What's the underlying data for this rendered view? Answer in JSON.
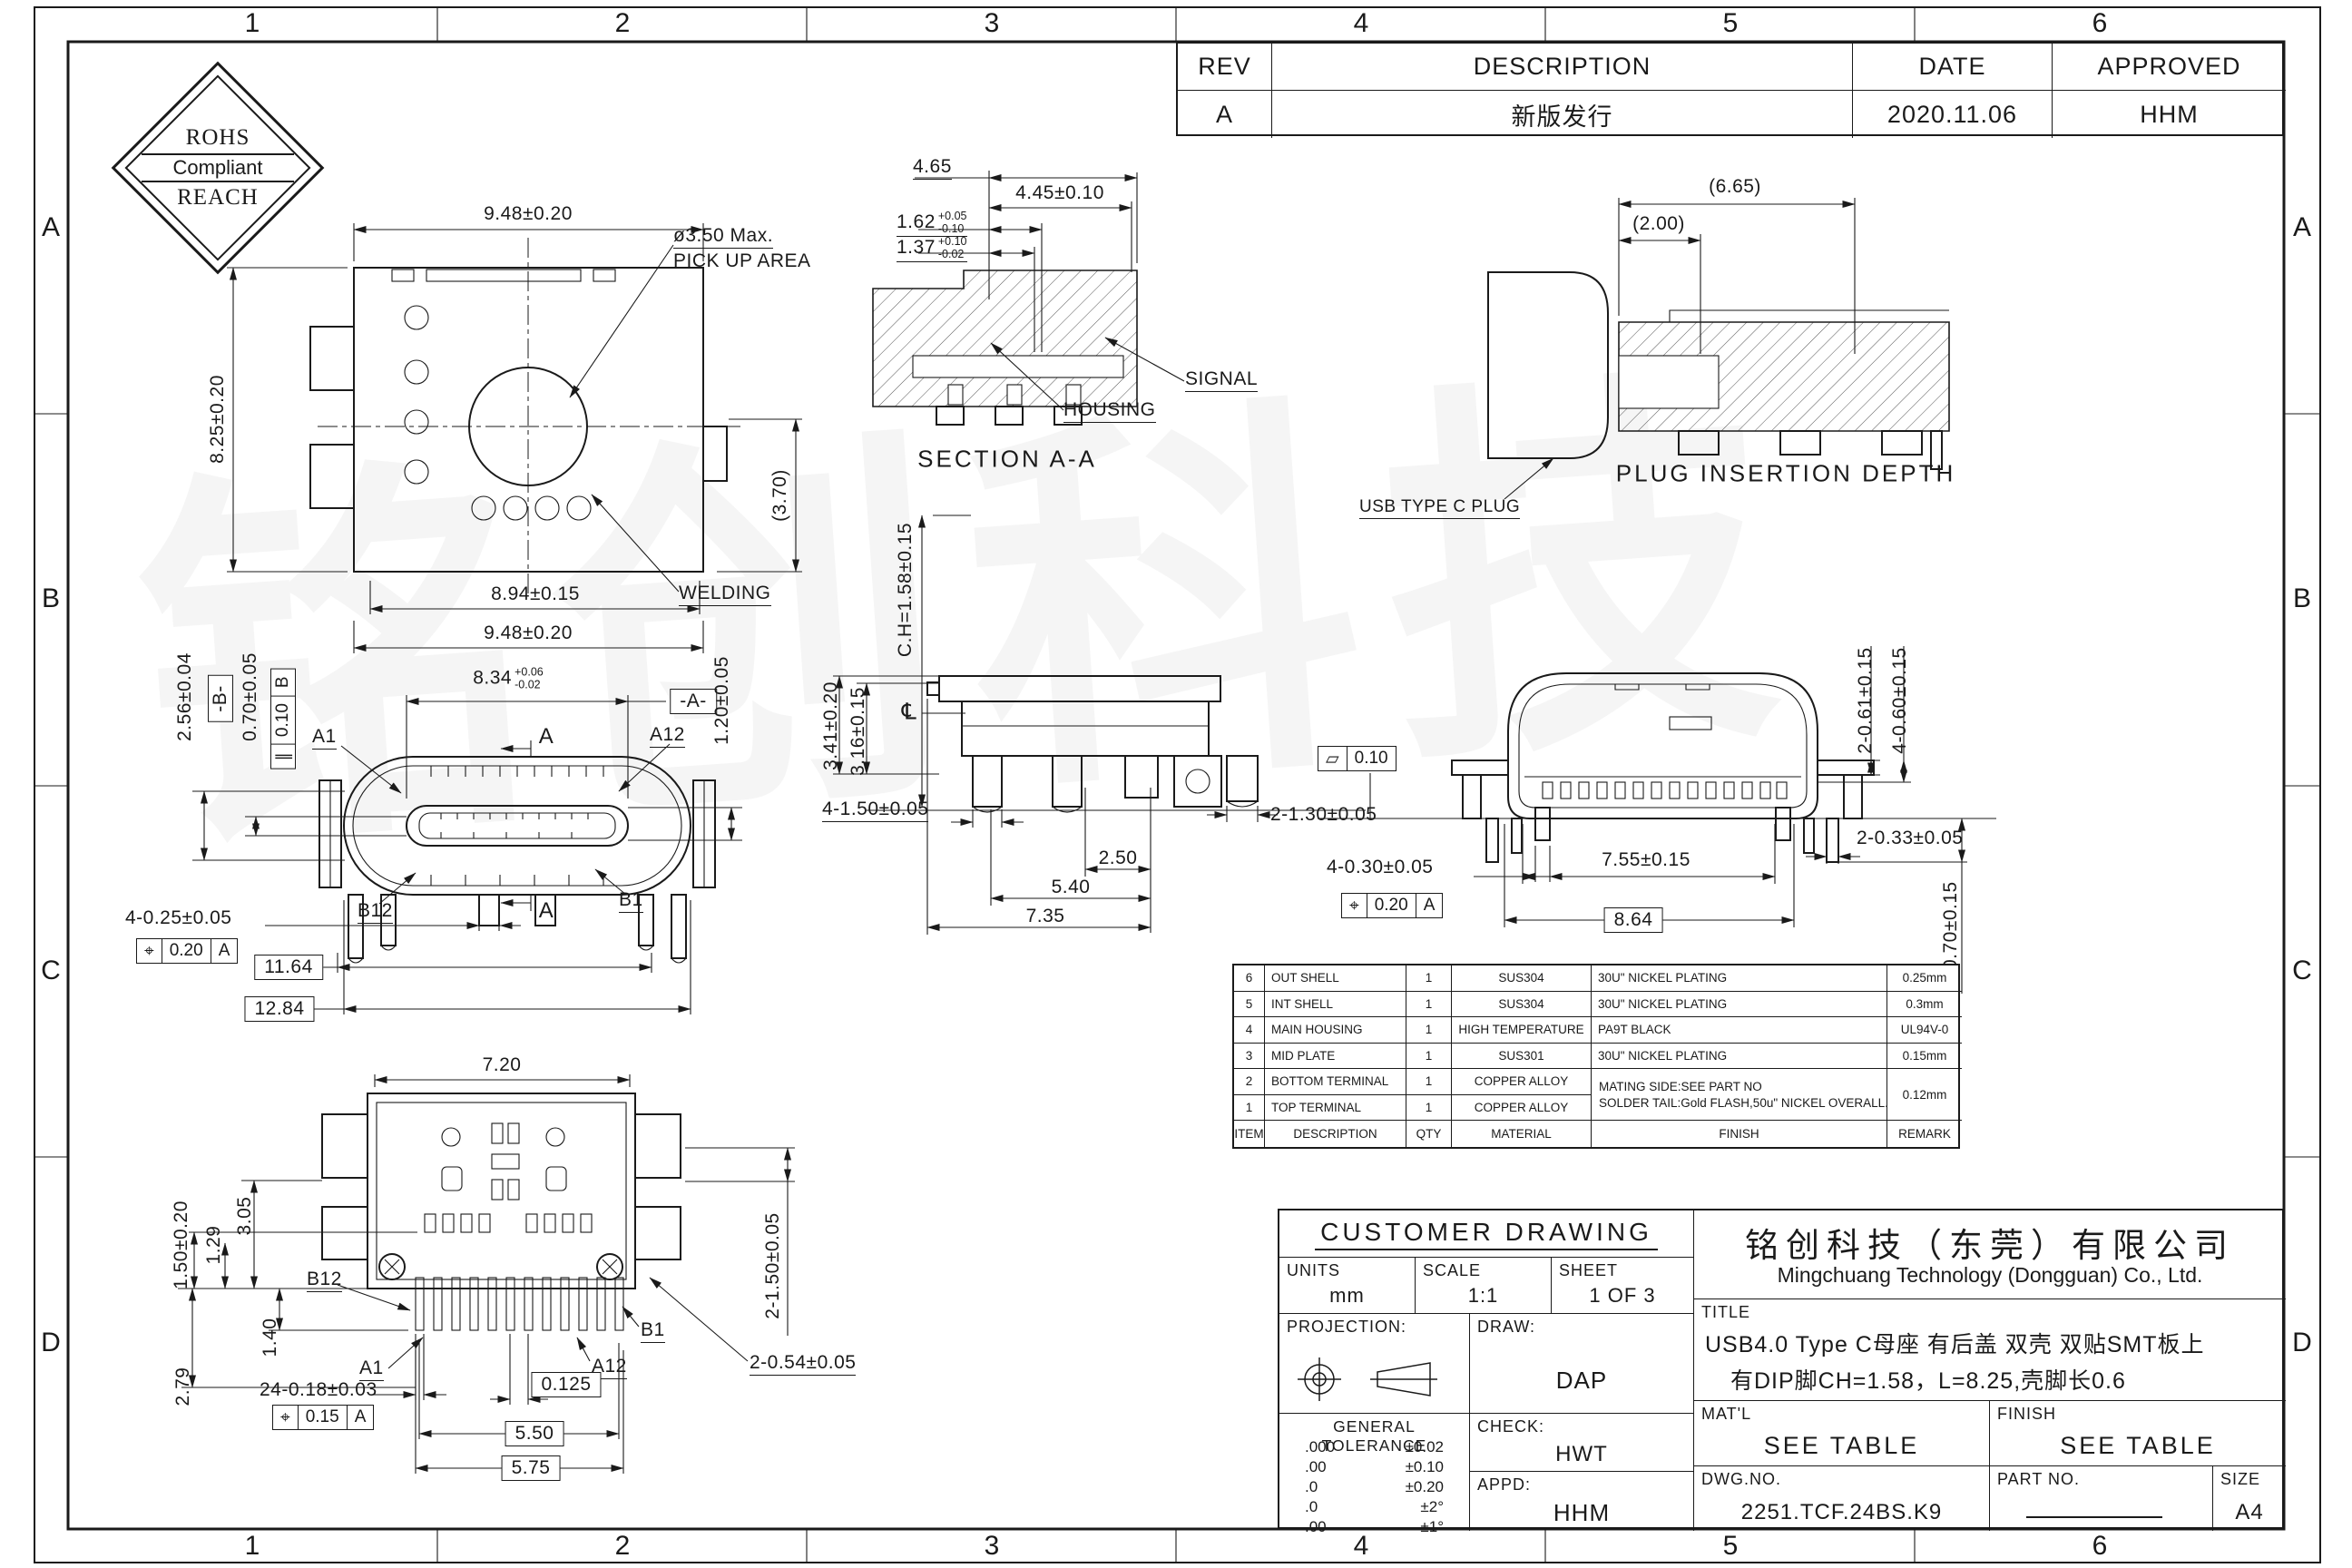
{
  "sheet": {
    "cols": [
      "1",
      "2",
      "3",
      "4",
      "5",
      "6"
    ],
    "rows": [
      "A",
      "B",
      "C",
      "D"
    ],
    "watermark": "铭创科技"
  },
  "badge": {
    "top": "ROHS",
    "mid": "Compliant",
    "bottom": "REACH"
  },
  "rev_table": {
    "headers": {
      "rev": "REV",
      "description": "DESCRIPTION",
      "date": "DATE",
      "approved": "APPROVED"
    },
    "row": {
      "rev": "A",
      "description": "新版发行",
      "date": "2020.11.06",
      "approved": "HHM"
    }
  },
  "top_view": {
    "dim_width_top": "9.48±0.20",
    "dim_height_left": "8.25±0.20",
    "dim_width_bot1": "8.94±0.15",
    "dim_width_bot2": "9.48±0.20",
    "dim_depth": "(3.70)",
    "pickup_line1": "ø3.50  Max.",
    "pickup_line2": "PICK UP AREA",
    "welding": "WELDING"
  },
  "section_view": {
    "title": "SECTION A-A",
    "dim_465": "4.65",
    "dim_445": "4.45±0.10",
    "dim_162": "1.62",
    "dim_162_up": "+0.05",
    "dim_162_dn": "-0.10",
    "dim_137": "1.37",
    "dim_137_up": "+0.10",
    "dim_137_dn": "-0.02",
    "label_signal": "SIGNAL",
    "label_housing": "HOUSING"
  },
  "plug_view": {
    "title": "PLUG INSERTION DEPTH",
    "dim_665": "(6.65)",
    "dim_200": "(2.00)",
    "label_plug": "USB TYPE C PLUG"
  },
  "front_view": {
    "dim_834": "8.34",
    "dim_834_up": "+0.06",
    "dim_834_dn": "-0.02",
    "datum_a": "-A-",
    "datum_b": "-B-",
    "dim_256": "2.56±0.04",
    "dim_070": "0.70±0.05",
    "fcf_par": {
      "sym": "∥",
      "val": "0.10",
      "ref": "B"
    },
    "dim_120": "1.20±0.05",
    "pin_a1": "A1",
    "pin_a12": "A12",
    "pin_b1": "B1",
    "pin_b12": "B12",
    "sec_mark": "A",
    "dim_feet": "4-0.25±0.05",
    "fcf_pos": {
      "sym": "⌖",
      "val": "0.20",
      "ref": "A"
    },
    "dim_1164": "11.64",
    "dim_1284": "12.84"
  },
  "side_view": {
    "dim_ch": "C.H=1.58±0.15",
    "centerline_sym": "℄",
    "dim_341": "3.41±0.20",
    "dim_316": "3.16±0.15",
    "dim_legs": "4-1.50±0.05",
    "dim_250": "2.50",
    "dim_540": "5.40",
    "dim_735": "7.35",
    "dim_130": "2-1.30±0.05"
  },
  "end_view": {
    "fcf_flat": {
      "sym": "▱",
      "val": "0.10"
    },
    "dim_061": "2-0.61±0.15",
    "dim_060": "4-0.60±0.15",
    "dim_033": "2-0.33±0.05",
    "dim_755": "7.55±0.15",
    "dim_864": "8.64",
    "dim_030": "4-0.30±0.05",
    "fcf_pos": {
      "sym": "⌖",
      "val": "0.20",
      "ref": "A"
    },
    "dim_070": "4-0.70±0.15"
  },
  "bottom_view": {
    "dim_720": "7.20",
    "dim_150": "1.50±0.20",
    "dim_129": "1.29",
    "dim_305": "3.05",
    "dim_140": "1.40",
    "dim_279": "2.79",
    "pin_b12": "B12",
    "pin_a1": "A1",
    "pin_a12": "A12",
    "pin_b1": "B1",
    "dim_pins": "24-0.18±0.03",
    "fcf_pos": {
      "sym": "⌖",
      "val": "0.15",
      "ref": "A"
    },
    "dim_0125": "0.125",
    "dim_550": "5.50",
    "dim_575": "5.75",
    "dim_2150": "2-1.50±0.05",
    "dim_054": "2-0.54±0.05"
  },
  "bom": {
    "headers": [
      "ITEM",
      "DESCRIPTION",
      "QTY",
      "MATERIAL",
      "FINISH",
      "REMARK"
    ],
    "rows": [
      [
        "6",
        "OUT SHELL",
        "1",
        "SUS304",
        "30U\" NICKEL PLATING",
        "0.25mm"
      ],
      [
        "5",
        "INT SHELL",
        "1",
        "SUS304",
        "30U\" NICKEL PLATING",
        "0.3mm"
      ],
      [
        "4",
        "MAIN HOUSING",
        "1",
        "HIGH TEMPERATURE",
        "PA9T  BLACK",
        "UL94V-0"
      ],
      [
        "3",
        "MID PLATE",
        "1",
        "SUS301",
        "30U\" NICKEL PLATING",
        "0.15mm"
      ],
      [
        "2",
        "BOTTOM TERMINAL",
        "1",
        "COPPER ALLOY",
        "MATING SIDE:SEE PART NO",
        "0.12mm"
      ],
      [
        "1",
        "TOP TERMINAL",
        "1",
        "COPPER ALLOY",
        "SOLDER TAIL:Gold FLASH,50u\" NICKEL OVERALL.",
        ""
      ]
    ]
  },
  "title_block": {
    "customer_drawing": "CUSTOMER DRAWING",
    "units_label": "UNITS",
    "units_value": "mm",
    "scale_label": "SCALE",
    "scale_value": "1:1",
    "sheet_label": "SHEET",
    "sheet_value": "1 OF 3",
    "projection_label": "PROJECTION:",
    "draw_label": "DRAW:",
    "draw_value": "DAP",
    "check_label": "CHECK:",
    "check_value": "HWT",
    "appd_label": "APPD:",
    "appd_value": "HHM",
    "tol_title": "GENERAL TOLERANCE",
    "tol_rows": [
      [
        ".000",
        "±0.02"
      ],
      [
        ".00",
        "±0.10"
      ],
      [
        ".0",
        "±0.20"
      ],
      [
        ".0",
        "±2°"
      ],
      [
        ".00",
        "±1°"
      ]
    ],
    "company_cn": "铭创科技（东莞）有限公司",
    "company_en": "Mingchuang Technology (Dongguan) Co., Ltd.",
    "title_label": "TITLE",
    "title_line1": "USB4.0 Type C母座 有后盖 双壳 双贴SMT板上",
    "title_line2": "有DIP脚CH=1.58，L=8.25,壳脚长0.6",
    "matl_label": "MAT'L",
    "matl_value": "SEE TABLE",
    "finish_label": "FINISH",
    "finish_value": "SEE TABLE",
    "dwg_label": "DWG.NO.",
    "dwg_value": "2251.TCF.24BS.K9",
    "part_label": "PART NO.",
    "size_label": "SIZE",
    "size_value": "A4"
  }
}
